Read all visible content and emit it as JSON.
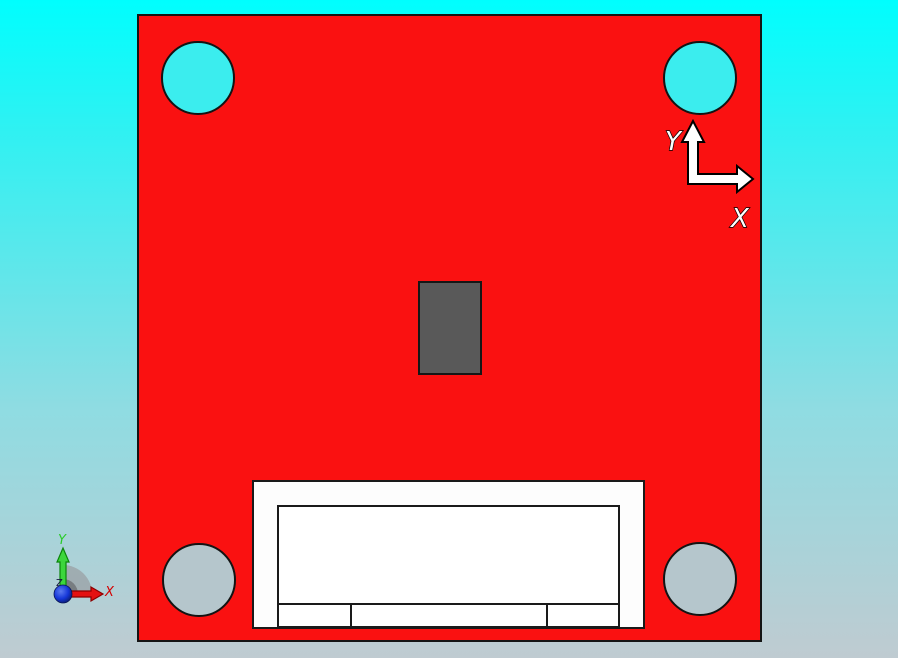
{
  "viewport": {
    "background_top_color": "#00FEFE",
    "background_bottom_color": "#BFCBD1"
  },
  "board": {
    "face_color": "#FA1111",
    "outline_color": "#141414",
    "hole_top_fill": "#3BEDEE",
    "hole_bottom_fill": "#B5C6CC",
    "component_fill": "#595959",
    "connector_fill": "#FDFDFD"
  },
  "axis_indicator": {
    "y_label": "Y",
    "x_label": "X",
    "arrow_fill": "#FFFFFF",
    "arrow_outline": "#000000"
  },
  "origin_triad": {
    "y_label": "Y",
    "x_label": "X",
    "z_label": "Z",
    "y_axis_color": "#2BCB2B",
    "x_axis_color": "#E41111",
    "origin_sphere_color": "#1536D8",
    "fan_color": "#9AA0A4"
  }
}
